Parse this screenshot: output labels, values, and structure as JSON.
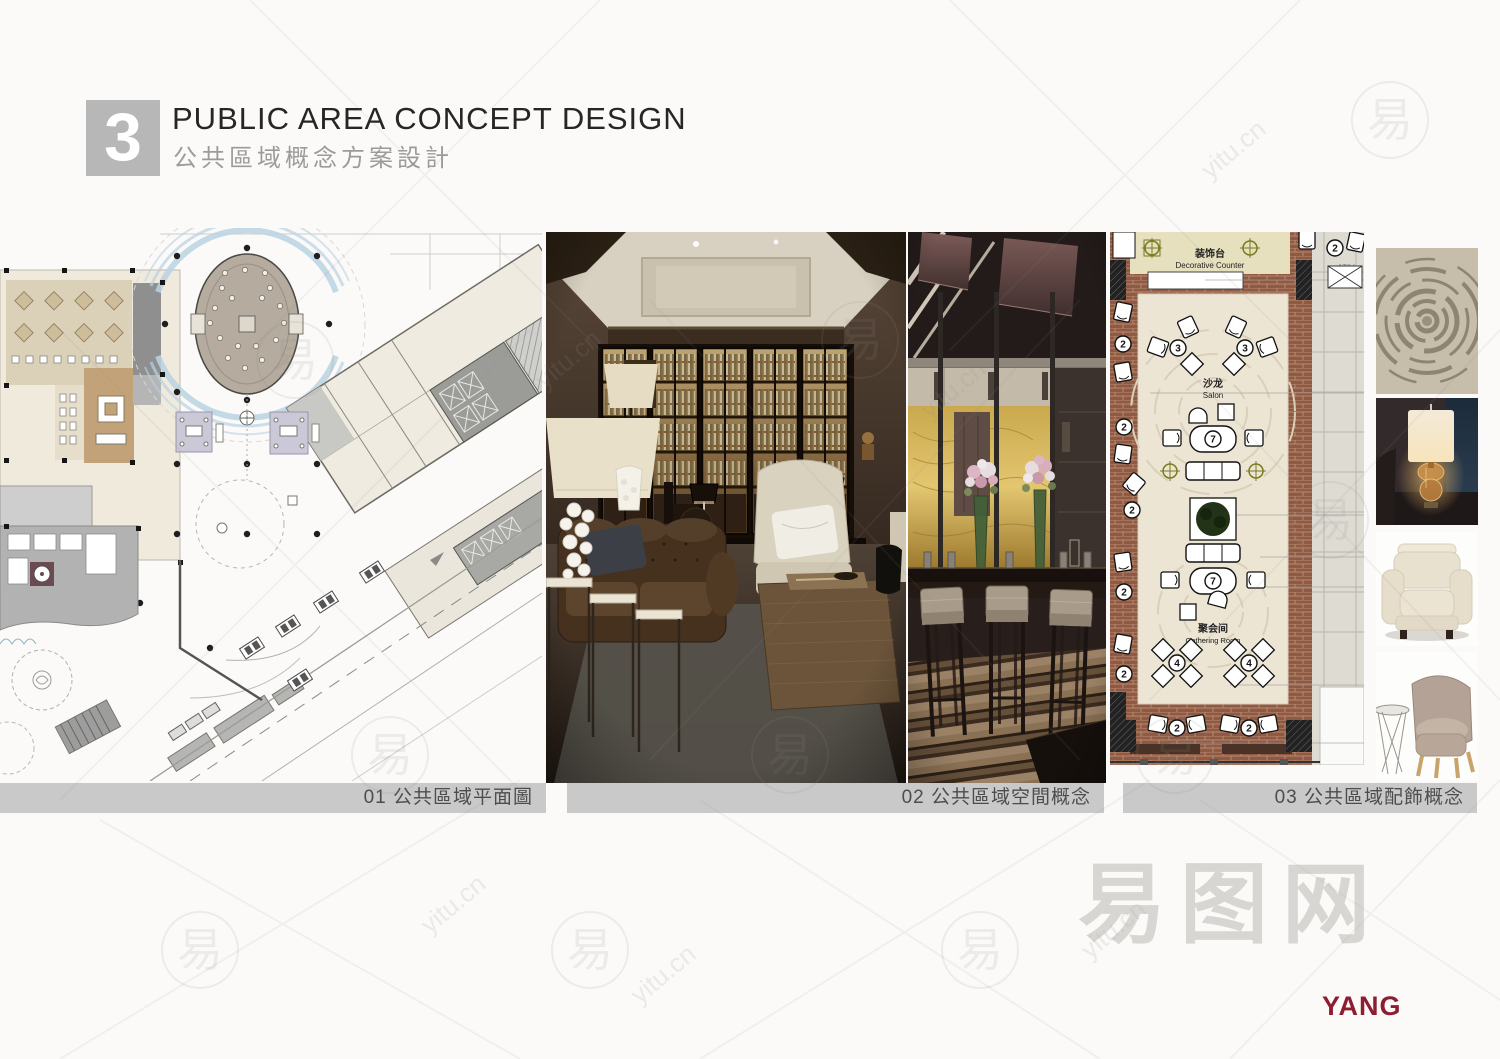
{
  "header": {
    "number": "3",
    "title": "PUBLIC AREA CONCEPT DESIGN",
    "subtitle": "公共區域概念方案設計"
  },
  "captions": {
    "plan": "01 公共區域平面圖",
    "space": "02 公共區域空間概念",
    "decor": "03 公共區域配飾概念"
  },
  "plan03": {
    "decorative_counter_cn": "装饰台",
    "decorative_counter_en": "Decorative Counter",
    "salon_cn": "沙龙",
    "salon_en": "Salon",
    "gathering_cn": "聚会间",
    "gathering_en": "Gathering Room",
    "callout_fragment": "ATIV",
    "badges": [
      "2",
      "2",
      "2",
      "2",
      "2",
      "2",
      "3",
      "3",
      "7",
      "7",
      "4",
      "4",
      "2",
      "2"
    ]
  },
  "watermark": {
    "glyph": "易",
    "site": "yitu.cn",
    "brand": "易图网"
  },
  "logo": {
    "text": "YANG",
    "color": "#8e1d32"
  },
  "colors": {
    "caption_bar": "#c9c9c9",
    "section_box": "#b7b7b7",
    "brick": "#8f5a45",
    "onyx_gold": "#d6b458",
    "plan_blue": "#b9d2e2",
    "logo_red": "#8e1d32"
  }
}
